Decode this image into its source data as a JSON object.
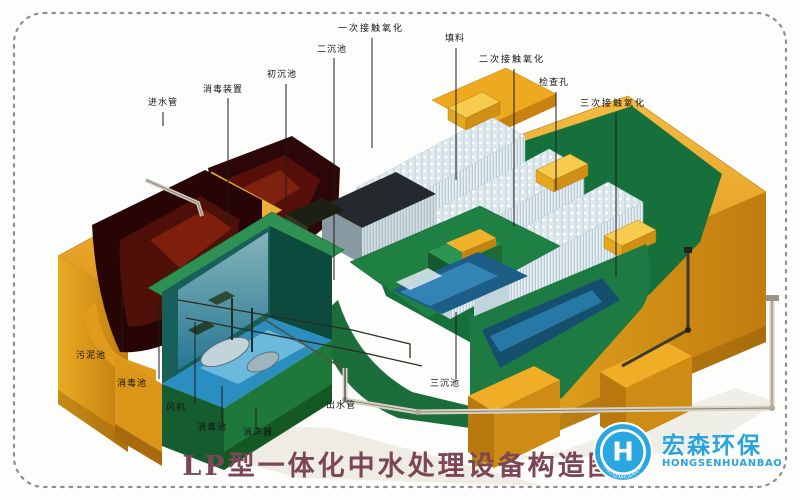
{
  "diagram": {
    "title": "LP型一体化中水处理设备构造图",
    "labels": [
      {
        "id": "inlet-pipe",
        "text": "进水管"
      },
      {
        "id": "disinfection-device",
        "text": "消毒装置"
      },
      {
        "id": "primary-sedimentation-tank",
        "text": "初沉池"
      },
      {
        "id": "secondary-sedimentation-tank",
        "text": "二沉池"
      },
      {
        "id": "first-contact-oxidation",
        "text": "一次接触氧化"
      },
      {
        "id": "packing-media",
        "text": "填料"
      },
      {
        "id": "second-contact-oxidation",
        "text": "二次接触氧化"
      },
      {
        "id": "inspection-hole",
        "text": "检查孔"
      },
      {
        "id": "third-contact-oxidation",
        "text": "三次接触氧化"
      },
      {
        "id": "sludge-tank",
        "text": "污泥池"
      },
      {
        "id": "disinfection-tank",
        "text": "消毒池"
      },
      {
        "id": "blower",
        "text": "风机"
      },
      {
        "id": "disinfection-tank-2",
        "text": "消毒池"
      },
      {
        "id": "silencer",
        "text": "消声器"
      },
      {
        "id": "outlet-pipe",
        "text": "出水管"
      },
      {
        "id": "tertiary-sedimentation-tank",
        "text": "三沉池"
      }
    ]
  },
  "logo": {
    "name_cn": "宏森环保",
    "name_en": "HONGSENHUANBAO",
    "badge_text": "HONGSENHUANBAO",
    "badge_letter": "H"
  },
  "colors": {
    "tank_orange": "#e8a41f",
    "wall_green": "#1f7a42",
    "sludge_maroon": "#3a0a08",
    "water_blue": "#2a8fc0",
    "packing_white": "#e7eff3",
    "title_plum": "#7c4657",
    "logo_blue": "#29a7e0",
    "label_ink": "#151515"
  }
}
